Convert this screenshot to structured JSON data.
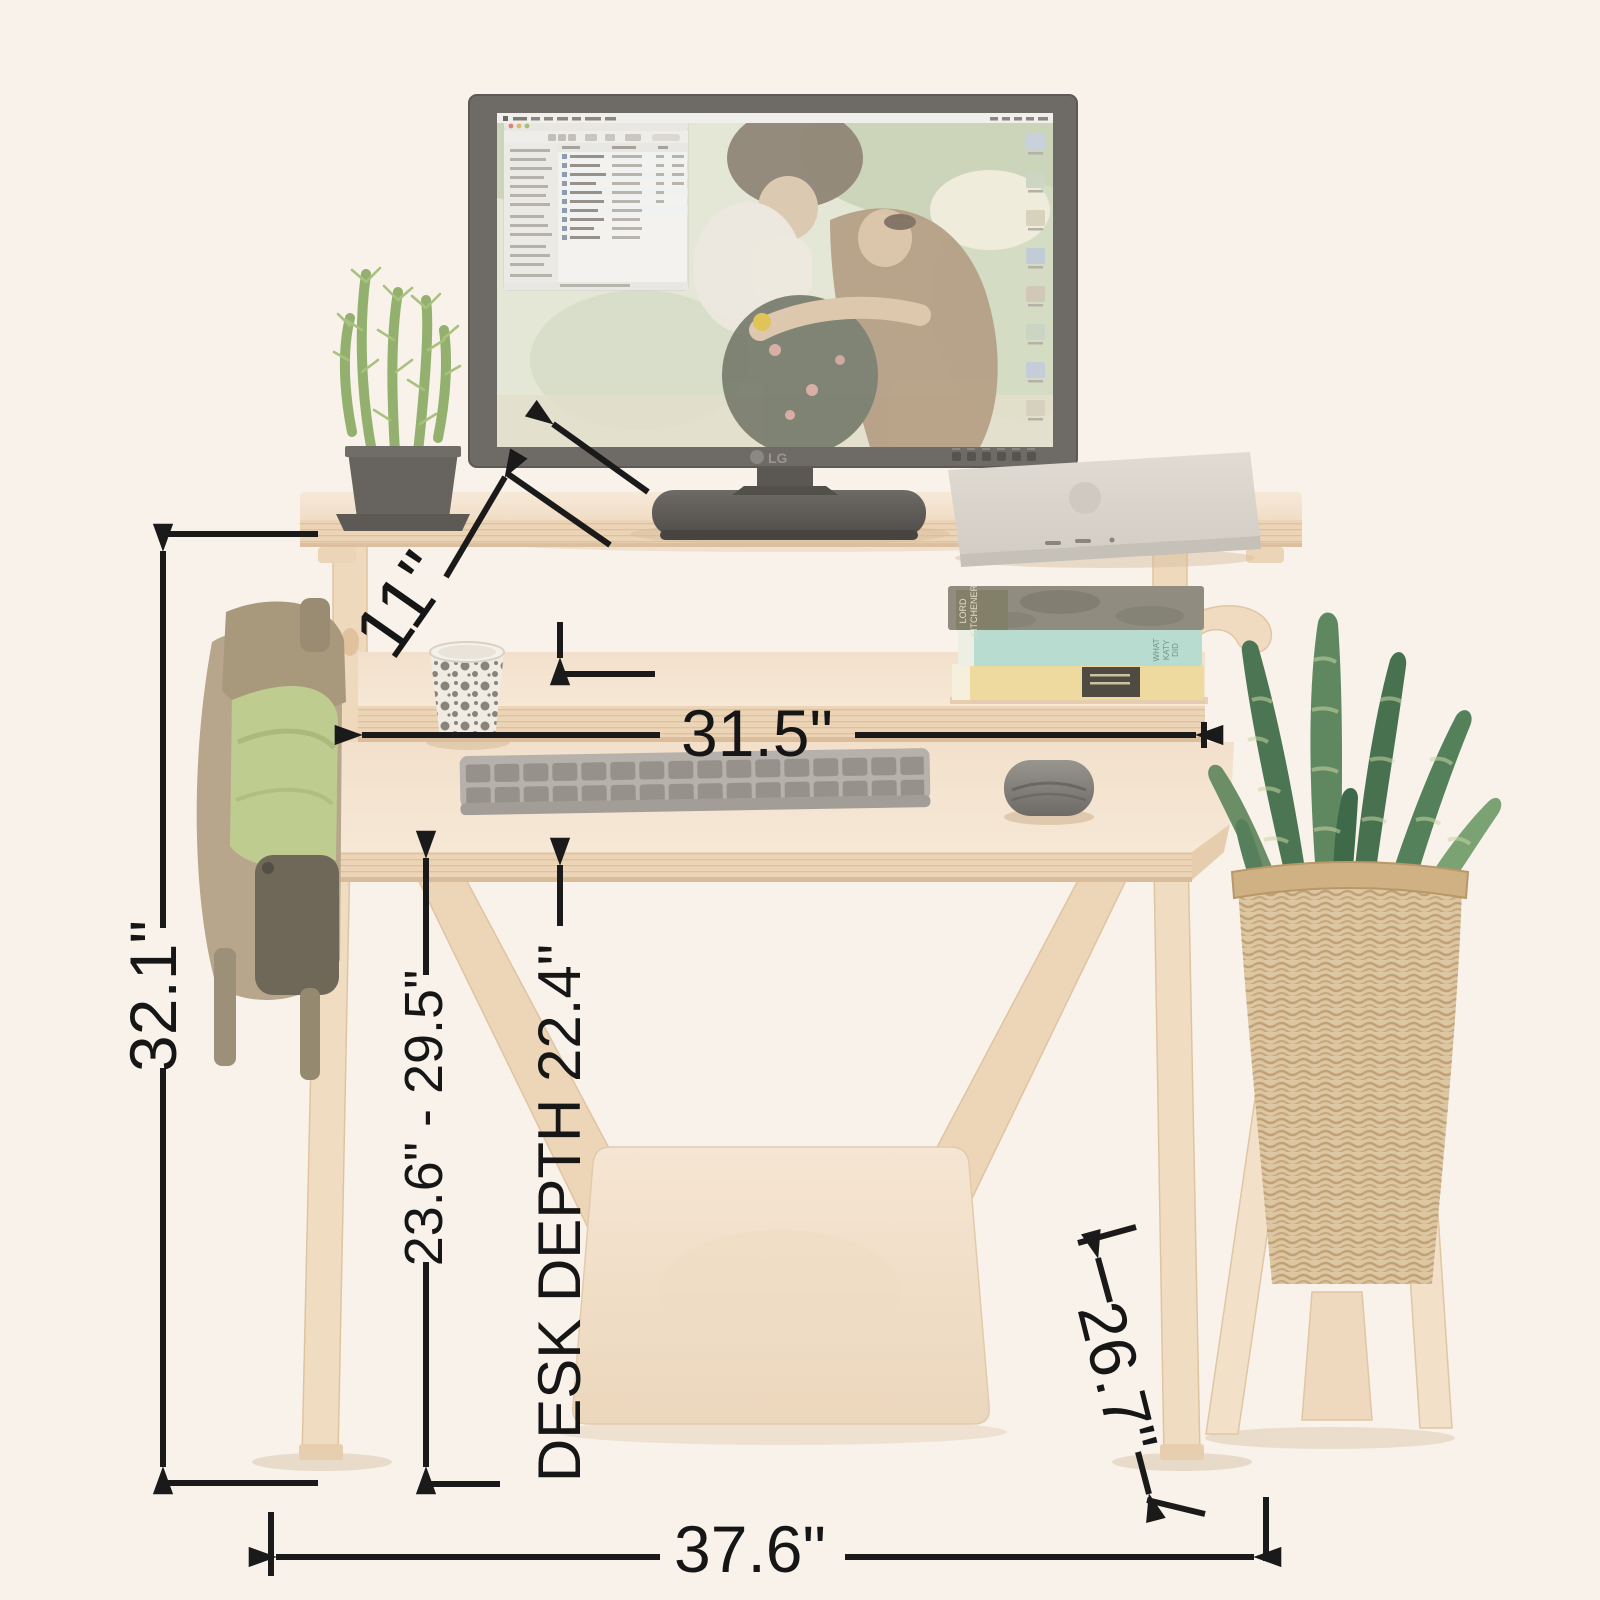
{
  "dimensions": {
    "riser_height": "11\"",
    "upper_shelf_width": "31.5\"",
    "overall_height": "32.1\"",
    "desk_height_range": "23.6\" - 29.5\"",
    "desk_depth": "DESK DEPTH 22.4\"",
    "base_depth": "26.7\"",
    "overall_width": "37.6\""
  },
  "objects": {
    "monitor_brand": "LG",
    "book_top_title": "LORD KITCHENER",
    "book_middle_title": "WHAT KATY DID"
  },
  "colors": {
    "background": "#f8f2ea",
    "annotation": "#1a1a1a",
    "wood": "#f0dcc5",
    "monitor_bezel": "#6e6a66",
    "teal_book": "#b8ddd0",
    "yellow_book": "#eeda9f",
    "plant_green": "#4c7553"
  }
}
